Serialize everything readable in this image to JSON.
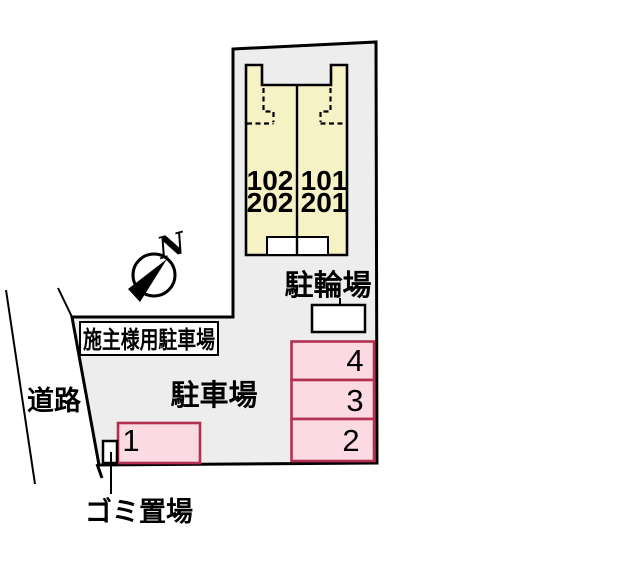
{
  "plan": {
    "title_context": "site-parking-layout",
    "building": {
      "units": [
        {
          "line1": "102",
          "line2": "202"
        },
        {
          "line1": "101",
          "line2": "201"
        }
      ]
    },
    "labels": {
      "bicycle_parking": "駐輪場",
      "owner_parking": "施主様用駐車場",
      "parking_lot": "駐車場",
      "road": "道路",
      "garbage": "ゴミ置場",
      "north": "N"
    },
    "parking_spaces": [
      {
        "number": "1"
      },
      {
        "number": "2"
      },
      {
        "number": "3"
      },
      {
        "number": "4"
      }
    ],
    "colors": {
      "site_fill": "#ededed",
      "building_fill": "#f6f2c6",
      "space_fill": "#fbdae3",
      "space_border": "#b23050",
      "outline": "#000000"
    }
  }
}
